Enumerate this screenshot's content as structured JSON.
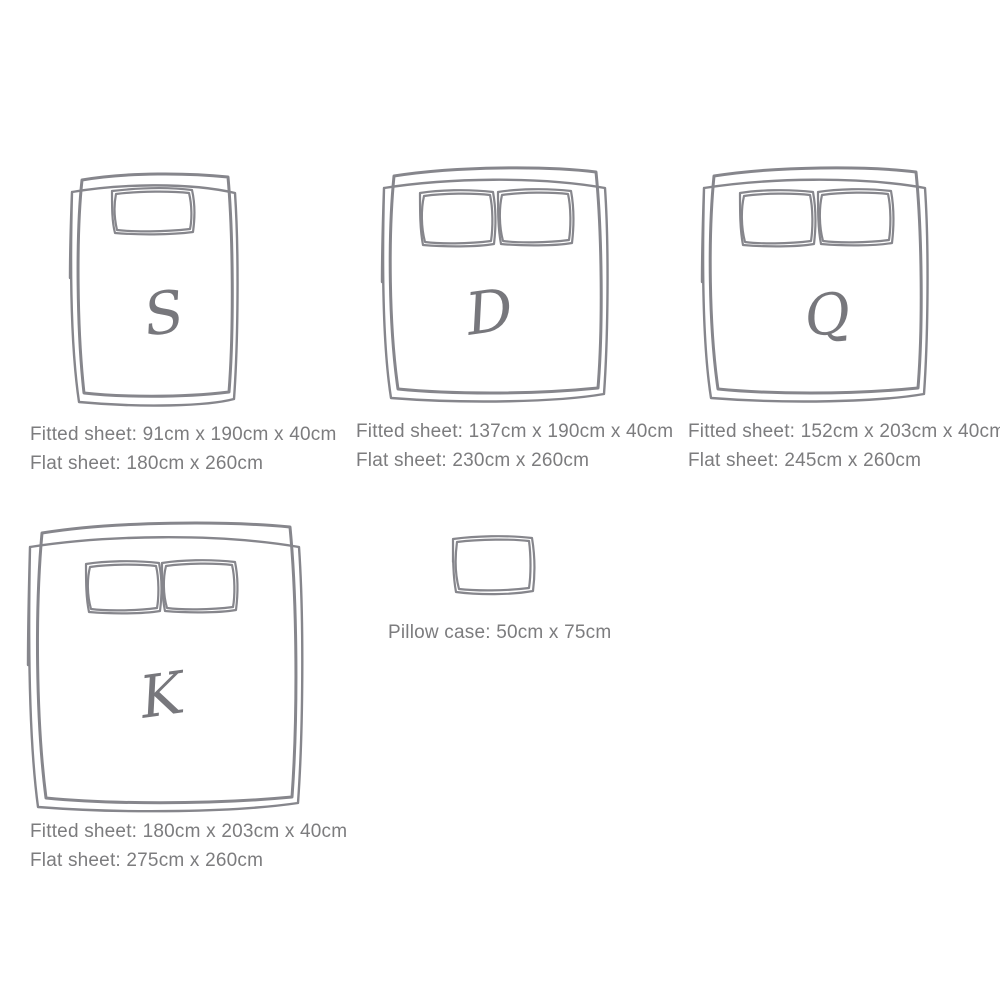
{
  "diagram_title": "Bed sheet size guide",
  "colors": {
    "sketch": "#86868c",
    "text": "#7c7c7e",
    "background": "#ffffff"
  },
  "beds": [
    {
      "name": "single",
      "letter": "S",
      "pillow_count": 1,
      "fitted": "Fitted sheet: 91cm x 190cm x 40cm",
      "flat": "Flat sheet: 180cm x 260cm"
    },
    {
      "name": "double",
      "letter": "D",
      "pillow_count": 2,
      "fitted": "Fitted sheet: 137cm x 190cm x 40cm",
      "flat": "Flat sheet: 230cm x 260cm"
    },
    {
      "name": "queen",
      "letter": "Q",
      "pillow_count": 2,
      "fitted": "Fitted sheet: 152cm x 203cm x 40cm",
      "flat": "Flat sheet: 245cm x 260cm"
    },
    {
      "name": "king",
      "letter": "K",
      "pillow_count": 2,
      "fitted": "Fitted sheet: 180cm x 203cm x 40cm",
      "flat": "Flat sheet: 275cm x 260cm"
    }
  ],
  "pillow_case": {
    "label": "Pillow case: 50cm x 75cm"
  }
}
